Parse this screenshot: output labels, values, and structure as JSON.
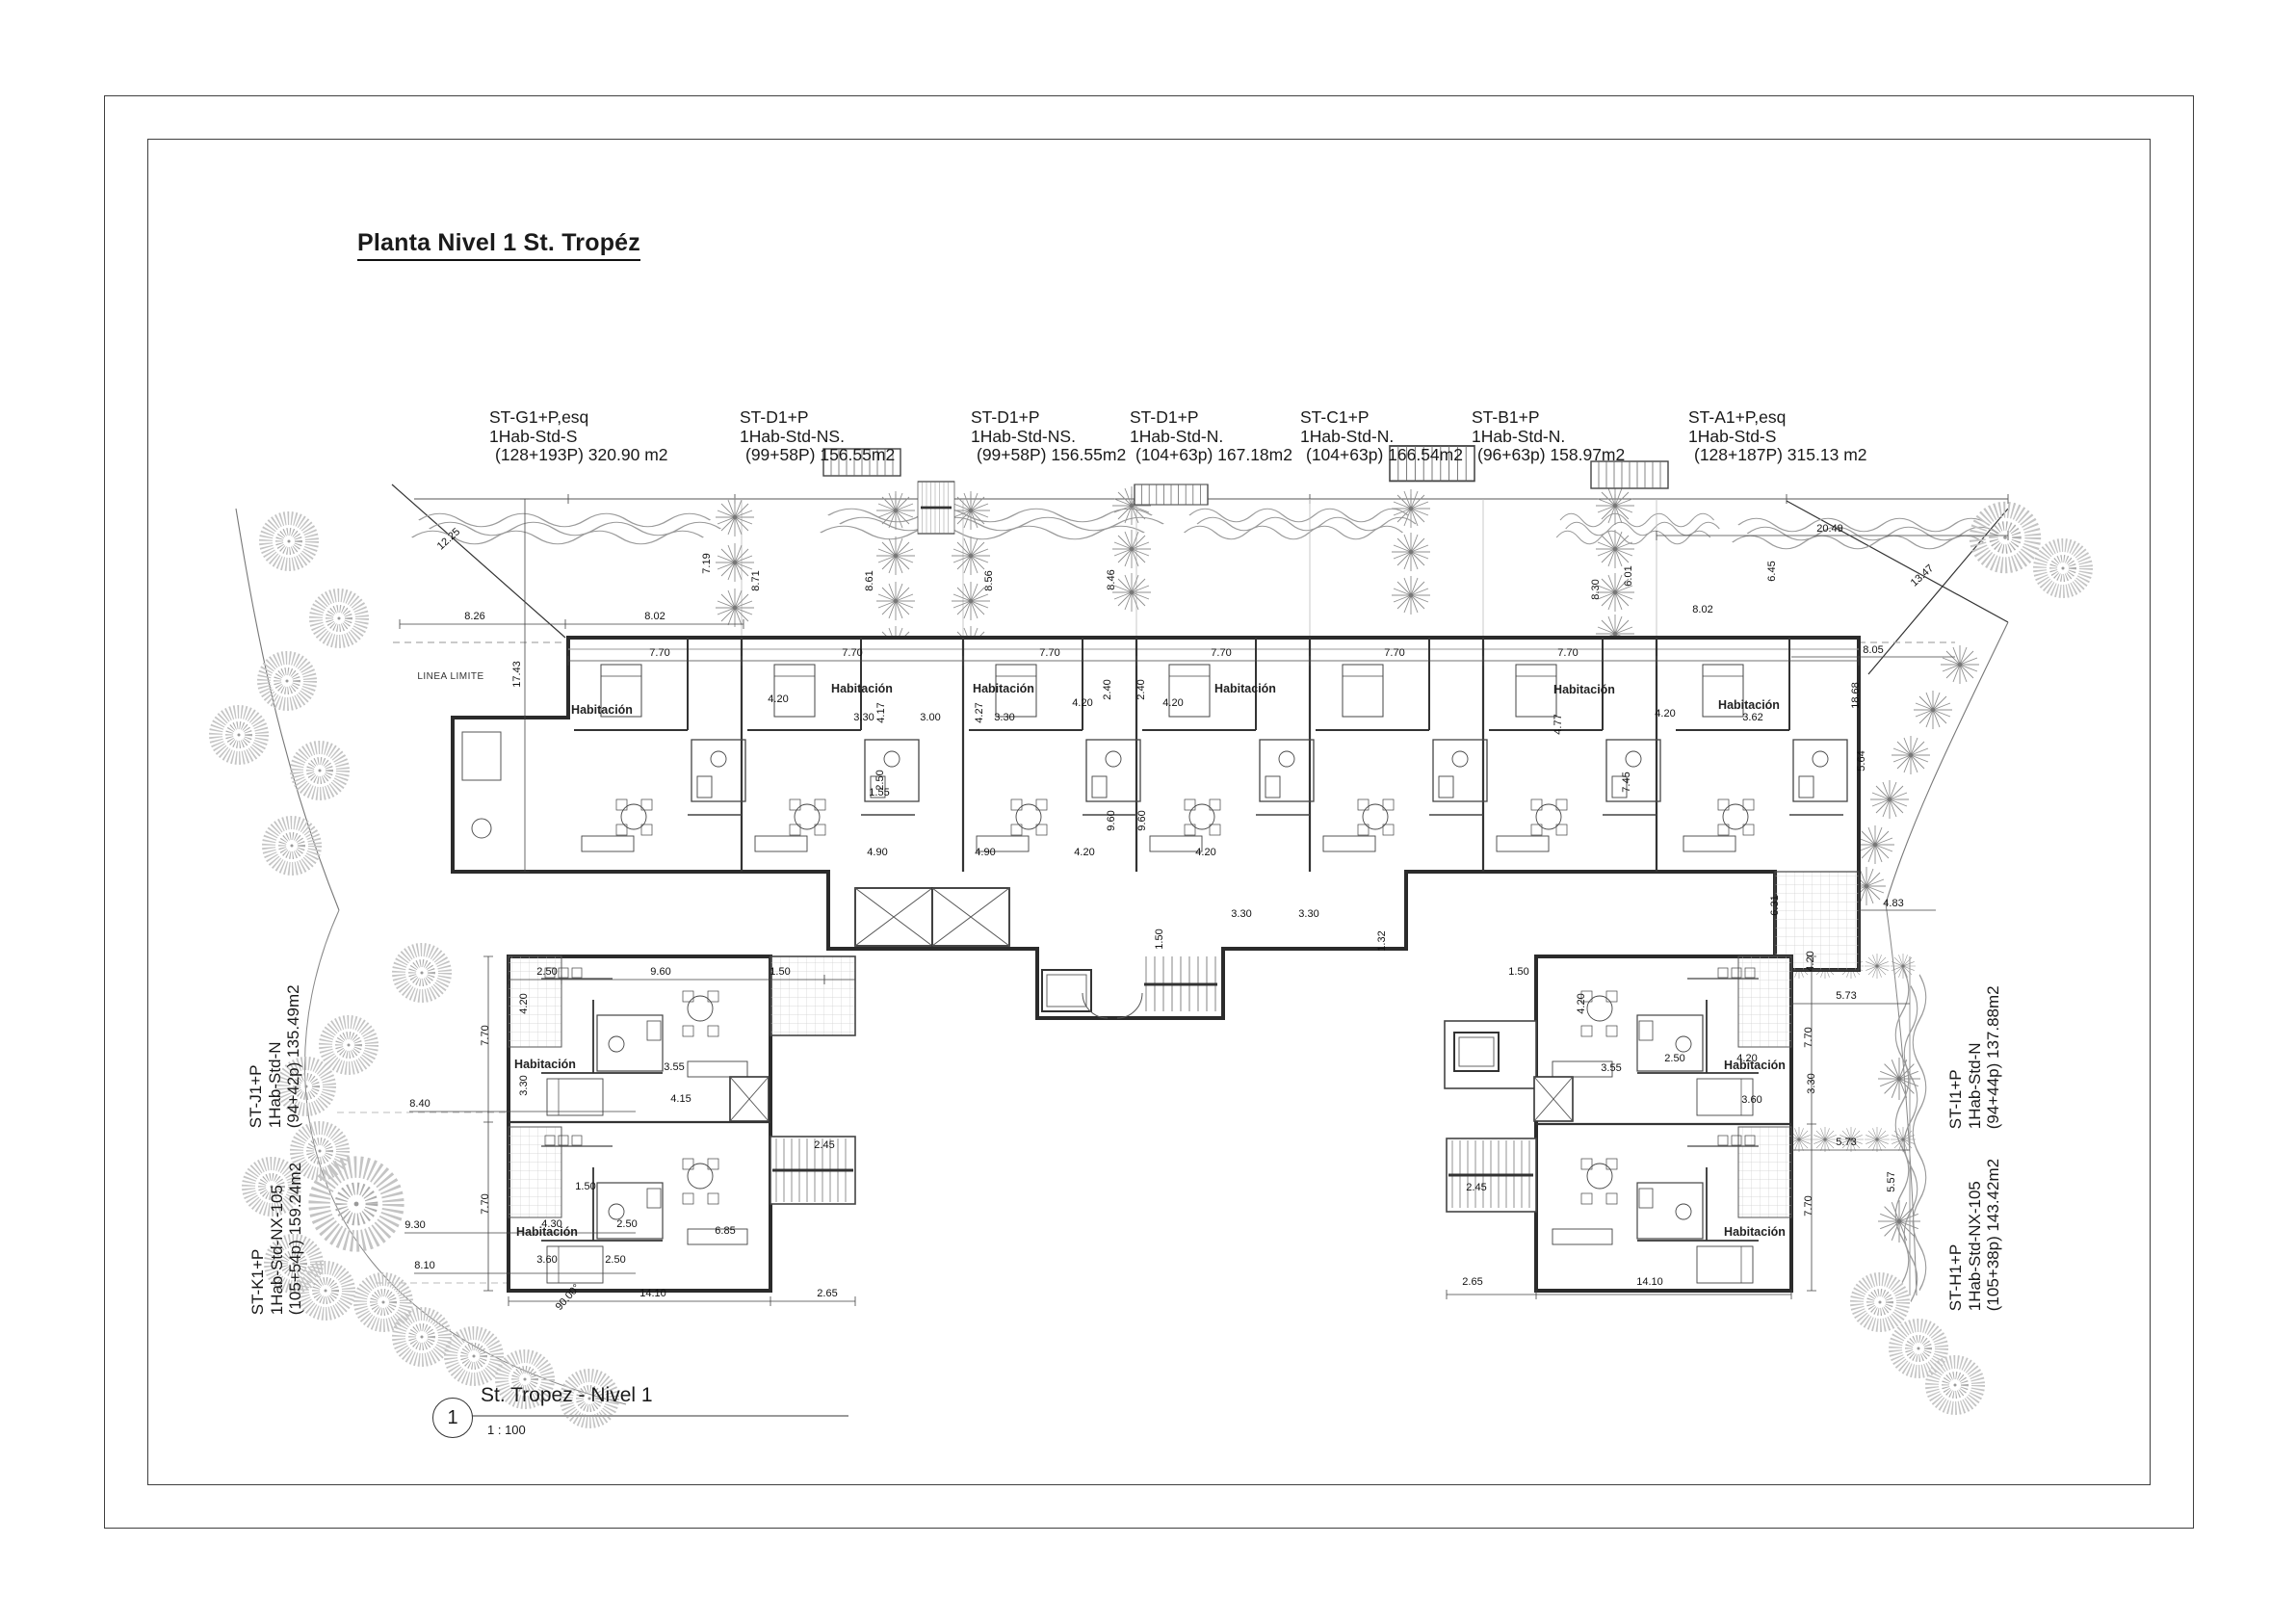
{
  "sheet": {
    "title": "Planta Nivel 1 St. Tropéz",
    "view": {
      "number": "1",
      "name": "St. Tropez  - Nivel 1",
      "scale": "1 : 100"
    }
  },
  "units_top": [
    {
      "model": "ST-G1+P,esq",
      "type": "1Hab-Std-S",
      "area": "(128+193P) 320.90 m2"
    },
    {
      "model": "ST-D1+P",
      "type": "1Hab-Std-NS.",
      "area": "(99+58P) 156.55m2"
    },
    {
      "model": "ST-D1+P",
      "type": "1Hab-Std-NS.",
      "area": "(99+58P) 156.55m2"
    },
    {
      "model": "ST-D1+P",
      "type": "1Hab-Std-N.",
      "area": "(104+63p) 167.18m2"
    },
    {
      "model": "ST-C1+P",
      "type": "1Hab-Std-N.",
      "area": "(104+63p) 166.54m2"
    },
    {
      "model": "ST-B1+P",
      "type": "1Hab-Std-N.",
      "area": "(96+63p) 158.97m2"
    },
    {
      "model": "ST-A1+P,esq",
      "type": "1Hab-Std-S",
      "area": "(128+187P) 315.13 m2"
    }
  ],
  "units_left": [
    {
      "model": "ST-J1+P",
      "type": "1Hab-Std-N",
      "area": "(94+42p) 135.49m2"
    },
    {
      "model": "ST-K1+P",
      "type": "1Hab-Std-NX-105",
      "area": "(105+54p) 159.24m2"
    }
  ],
  "units_right": [
    {
      "model": "ST-I1+P",
      "type": "1Hab-Std-N",
      "area": "(94+44p) 137.88m2"
    },
    {
      "model": "ST-H1+P",
      "type": "1Hab-Std-NX-105",
      "area": "(105+38p) 143.42m2"
    }
  ],
  "plan": {
    "room_label": "Habitación",
    "boundary_label": "LINEA LIMITE",
    "angle_label": "90.00°",
    "dims": [
      "8.26",
      "8.02",
      "17.43",
      "12.25",
      "7.19",
      "8.71",
      "8.61",
      "8.56",
      "8.46",
      "20.49",
      "6.45",
      "8.30",
      "6.01",
      "8.02",
      "8.05",
      "13.47",
      "18.68",
      "5.64",
      "7.70",
      "7.70",
      "7.70",
      "7.70",
      "7.70",
      "7.70",
      "3.00",
      "3.30",
      "3.30",
      "4.17",
      "4.27",
      "4.20",
      "4.20",
      "4.20",
      "2.40",
      "2.40",
      "9.60",
      "9.60",
      "4.90",
      "4.90",
      "1.55",
      "2.50",
      "4.20",
      "4.20",
      "1.50",
      "3.30",
      "3.30",
      "1.32",
      "2.50",
      "9.60",
      "1.50",
      "7.70",
      "7.70",
      "4.20",
      "3.30",
      "3.55",
      "4.15",
      "2.45",
      "1.50",
      "4.30",
      "2.50",
      "3.60",
      "2.50",
      "6.85",
      "14.10",
      "2.65",
      "8.40",
      "9.30",
      "8.10",
      "2.65",
      "14.10",
      "2.45",
      "1.50",
      "4.20",
      "5.73",
      "5.73",
      "5.57",
      "7.70",
      "7.70",
      "4.20",
      "3.30",
      "4.83",
      "6.31",
      "3.60",
      "4.20",
      "2.50",
      "3.55",
      "3.62",
      "4.20",
      "7.45",
      "4.77"
    ]
  }
}
